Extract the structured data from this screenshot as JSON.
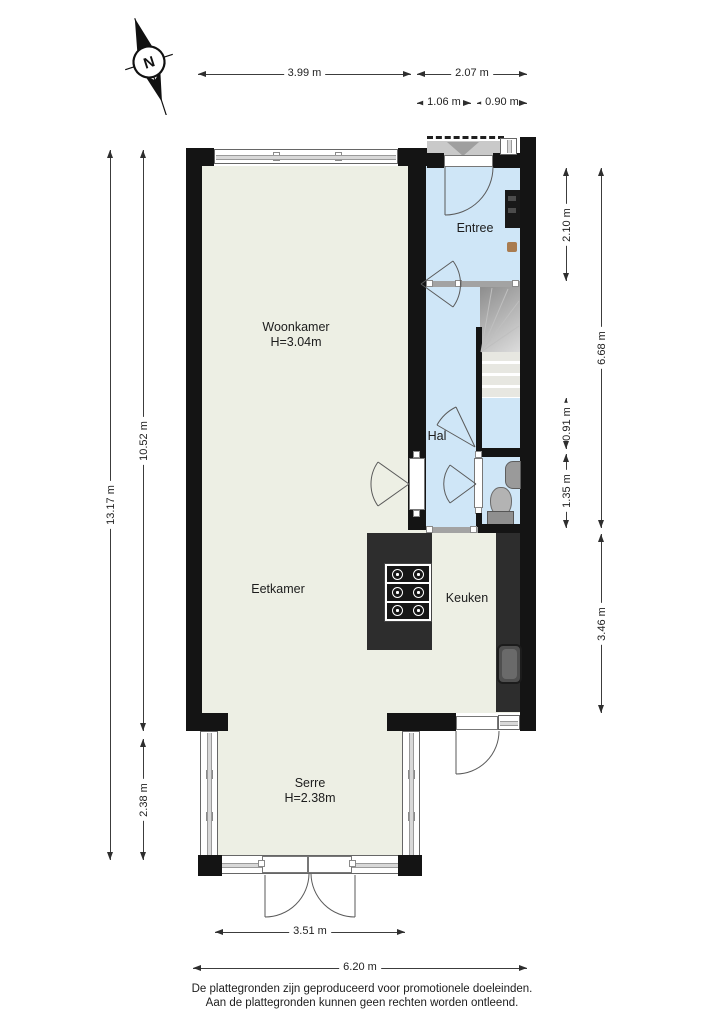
{
  "compass": {
    "north_label": "N"
  },
  "rooms": {
    "woonkamer": {
      "name": "Woonkamer",
      "ceiling": "H=3.04m"
    },
    "entree": {
      "name": "Entree"
    },
    "hal": {
      "name": "Hal"
    },
    "eetkamer": {
      "name": "Eetkamer"
    },
    "keuken": {
      "name": "Keuken"
    },
    "serre": {
      "name": "Serre",
      "ceiling": "H=2.38m"
    }
  },
  "dimensions": {
    "top_woonkamer_width": "3.99 m",
    "top_entree_width": "2.07 m",
    "top_porch_width": "1.06 m",
    "top_door_width": "0.90 m",
    "left_total_height": "13.17 m",
    "left_main_height": "10.52 m",
    "left_serre_height": "2.38 m",
    "right_entree_height": "2.10 m",
    "right_hal_height": "6.68 m",
    "right_stair_height": "0.91 m",
    "right_toilet_height": "1.35 m",
    "right_keuken_height": "3.46 m",
    "bottom_serre_width": "3.51 m",
    "bottom_total_width": "6.20 m"
  },
  "footer": {
    "line1": "De plattegronden zijn geproduceerd voor promotionele doeleinden.",
    "line2": "Aan de plattegronden kunnen geen rechten worden ontleend."
  },
  "colors": {
    "floor_living": "#edefe4",
    "floor_hall": "#cfe6f7",
    "wall": "#141414",
    "counter": "#2d2d2d",
    "porch": "#c9c9c9"
  }
}
